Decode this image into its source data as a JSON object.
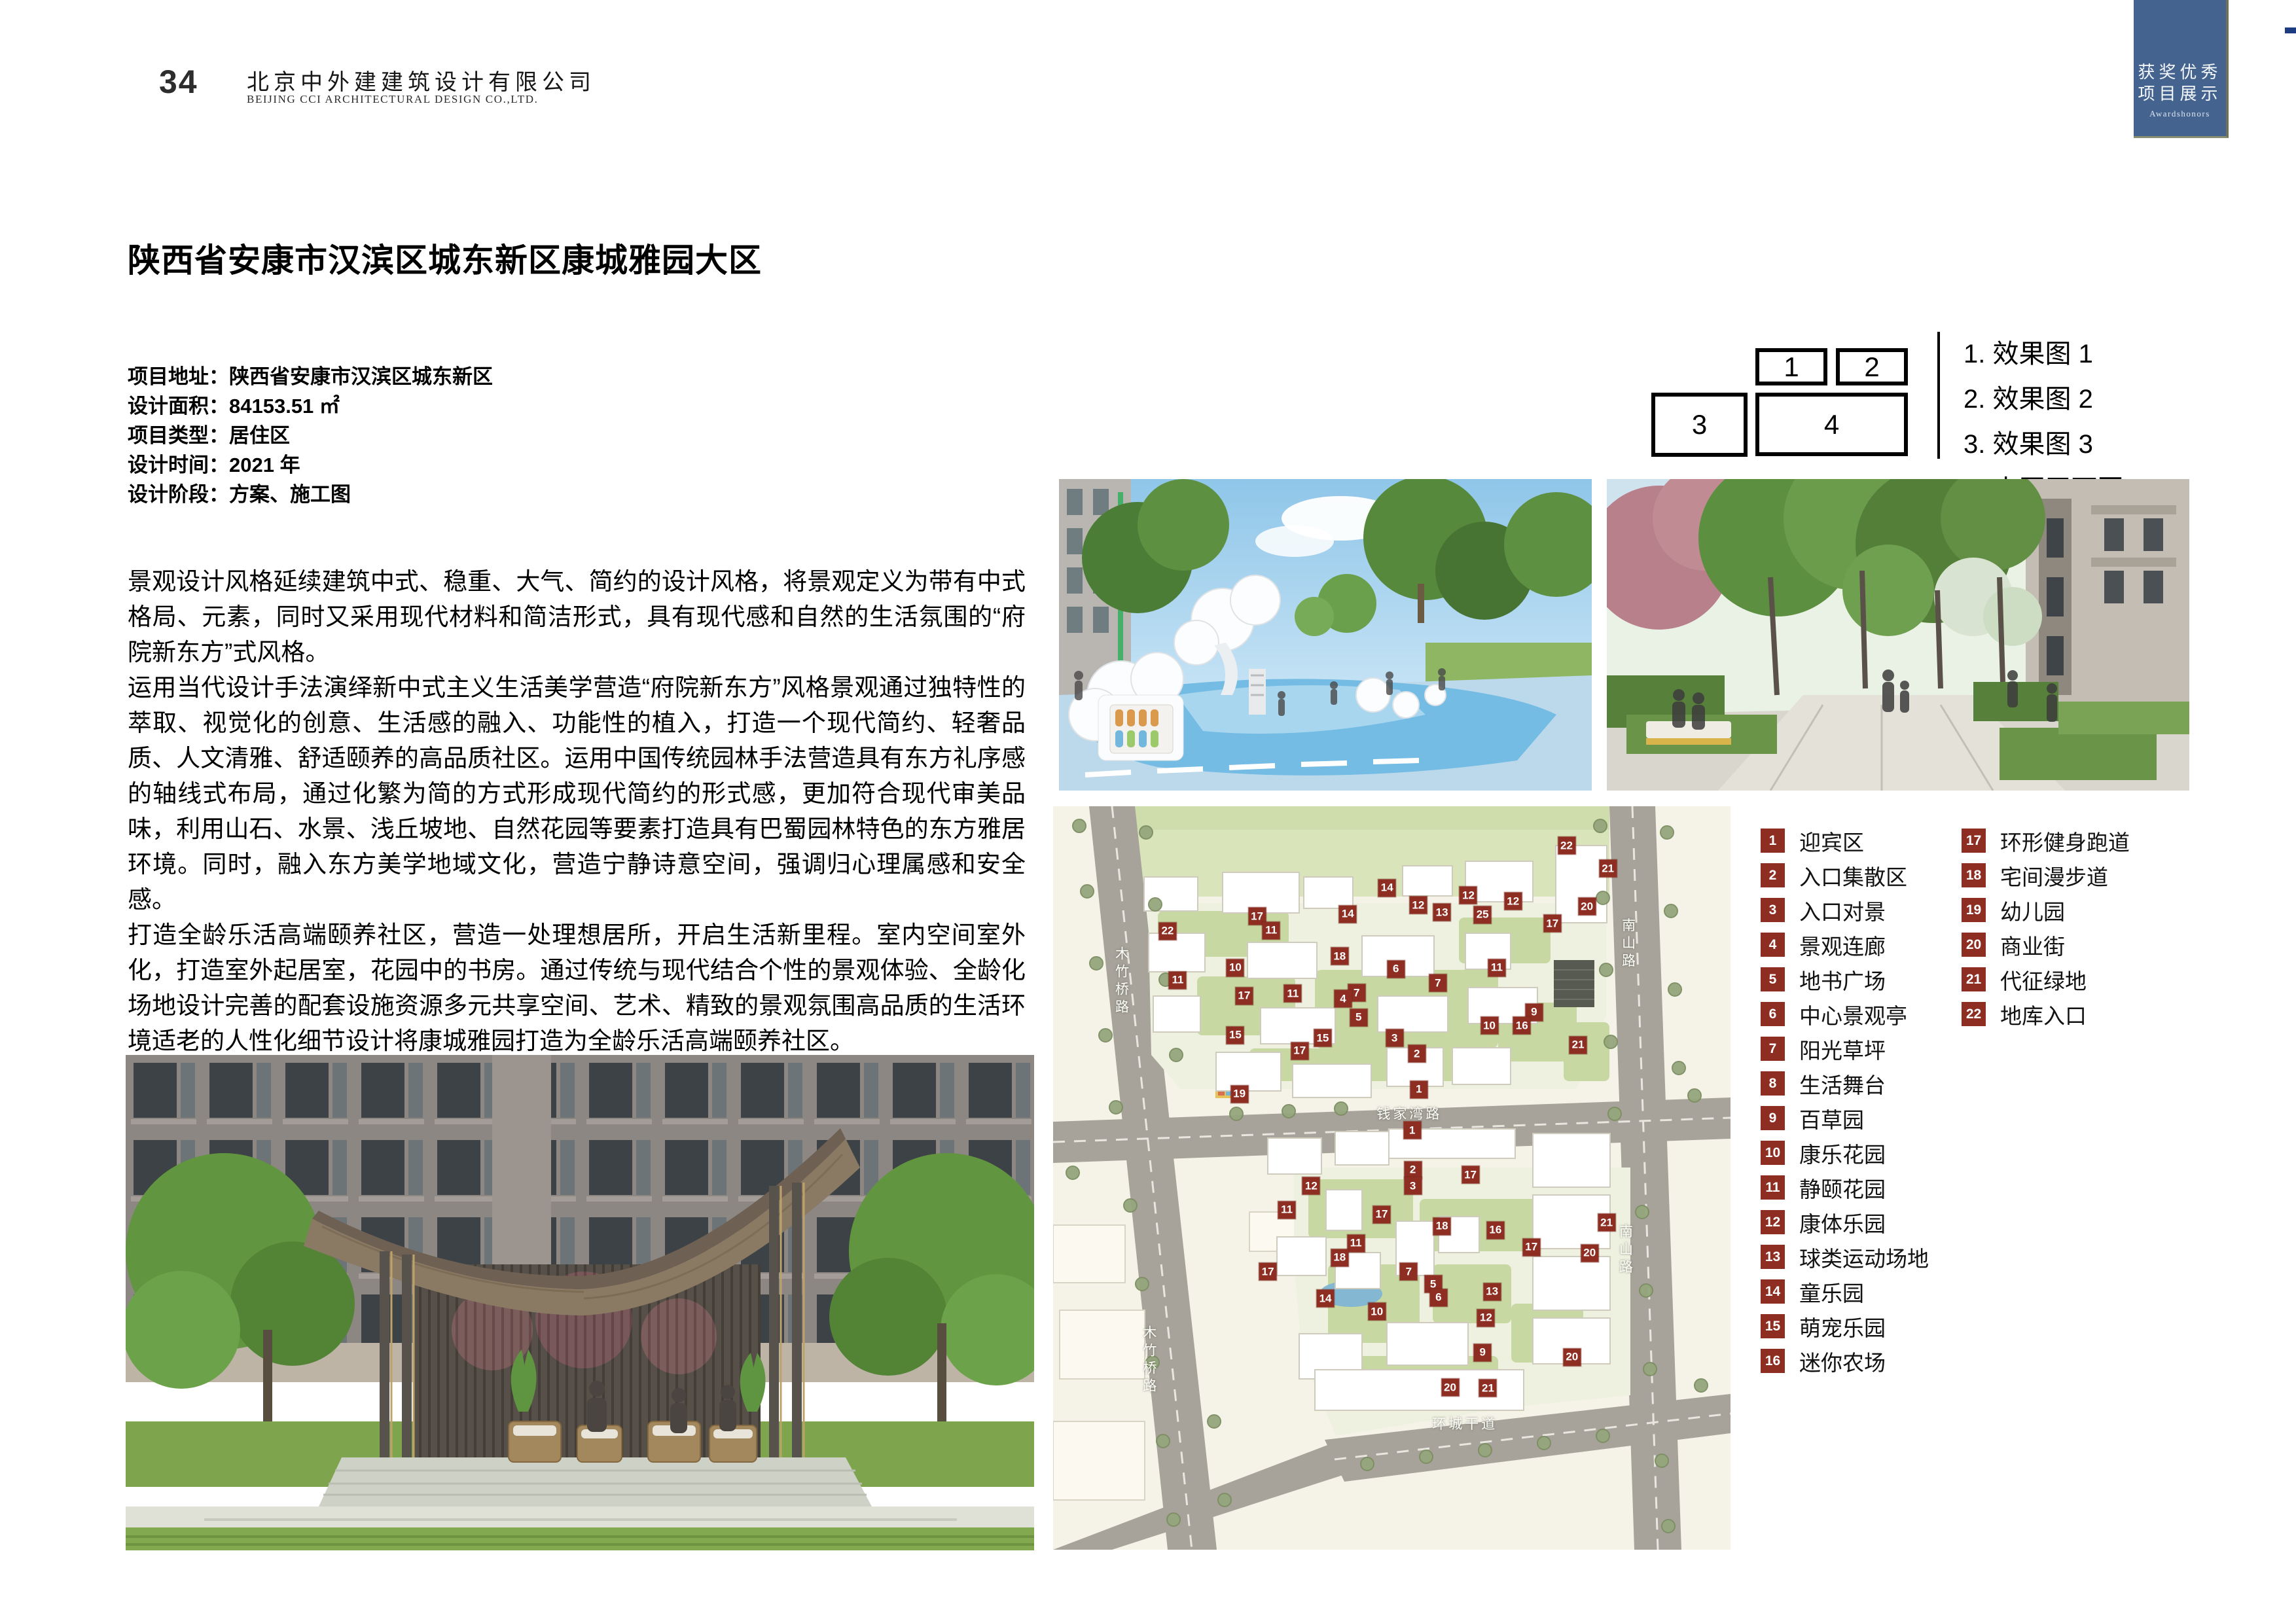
{
  "header": {
    "page_number": "34",
    "company_cn": "北京中外建建筑设计有限公司",
    "company_en": "BEIJING CCI ARCHITECTURAL DESIGN CO.,LTD."
  },
  "corner_tab": {
    "title_line1": "获奖优秀",
    "title_line2": "项目展示",
    "subtitle": "Awardshonors",
    "bg_color": "#44648f"
  },
  "project": {
    "title": "陕西省安康市汉滨区城东新区康城雅园大区",
    "info_rows": [
      {
        "label": "项目地址",
        "value": "陕西省安康市汉滨区城东新区"
      },
      {
        "label": "设计面积",
        "value": "84153.51 ㎡"
      },
      {
        "label": "项目类型",
        "value": "居住区"
      },
      {
        "label": "设计时间",
        "value": "2021 年"
      },
      {
        "label": "设计阶段",
        "value": "方案、施工图"
      }
    ],
    "description_p1": "景观设计风格延续建筑中式、稳重、大气、简约的设计风格，将景观定义为带有中式格局、元素，同时又采用现代材料和简洁形式，具有现代感和自然的生活氛围的“府院新东方”式风格。",
    "description_p2": "运用当代设计手法演绎新中式主义生活美学营造“府院新东方”风格景观通过独特性的萃取、视觉化的创意、生活感的融入、功能性的植入，打造一个现代简约、轻奢品质、人文清雅、舒适颐养的高品质社区。运用中国传统园林手法营造具有东方礼序感的轴线式布局，通过化繁为简的方式形成现代简约的形式感，更加符合现代审美品味，利用山石、水景、浅丘坡地、自然花园等要素打造具有巴蜀园林特色的东方雅居环境。同时，融入东方美学地域文化，营造宁静诗意空间，强调归心理属感和安全感。",
    "description_p3": "打造全龄乐活高端颐养社区，营造一处理想居所，开启生活新里程。室内空间室外化，打造室外起居室，花园中的书房。通过传统与现代结合个性的景观体验、全龄化场地设计完善的配套设施资源多元共享空间、艺术、精致的景观氛围高品质的生活环境适老的人性化细节设计将康城雅园打造为全龄乐活高端颐养社区。"
  },
  "key_diagram": {
    "boxes": [
      "1",
      "2",
      "3",
      "4"
    ],
    "list": [
      "1. 效果图 1",
      "2. 效果图 2",
      "3. 效果图 3",
      "4. 小区平面图"
    ]
  },
  "legend": {
    "badge_color": "#8e2e23",
    "columns": [
      [
        {
          "n": "1",
          "label": "迎宾区"
        },
        {
          "n": "2",
          "label": "入口集散区"
        },
        {
          "n": "3",
          "label": "入口对景"
        },
        {
          "n": "4",
          "label": "景观连廊"
        },
        {
          "n": "5",
          "label": "地书广场"
        },
        {
          "n": "6",
          "label": "中心景观亭"
        },
        {
          "n": "7",
          "label": "阳光草坪"
        },
        {
          "n": "8",
          "label": "生活舞台"
        },
        {
          "n": "9",
          "label": "百草园"
        },
        {
          "n": "10",
          "label": "康乐花园"
        },
        {
          "n": "11",
          "label": "静颐花园"
        },
        {
          "n": "12",
          "label": "康体乐园"
        },
        {
          "n": "13",
          "label": "球类运动场地"
        },
        {
          "n": "14",
          "label": "童乐园"
        },
        {
          "n": "15",
          "label": "萌宠乐园"
        },
        {
          "n": "16",
          "label": "迷你农场"
        }
      ],
      [
        {
          "n": "17",
          "label": "环形健身跑道"
        },
        {
          "n": "18",
          "label": "宅间漫步道"
        },
        {
          "n": "19",
          "label": "幼儿园"
        },
        {
          "n": "20",
          "label": "商业街"
        },
        {
          "n": "21",
          "label": "代征绿地"
        },
        {
          "n": "22",
          "label": "地库入口"
        }
      ]
    ]
  },
  "plan": {
    "road_labels": [
      {
        "text": "钱家湾路",
        "x": 52.6,
        "y": 41.3,
        "vertical": false
      },
      {
        "text": "环城干道",
        "x": 60.8,
        "y": 83.0,
        "vertical": false
      },
      {
        "text": "木竹桥路",
        "x": 10.0,
        "y": 23.6,
        "vertical": true
      },
      {
        "text": "木竹桥路",
        "x": 14.1,
        "y": 74.6,
        "vertical": true
      },
      {
        "text": "南山路",
        "x": 84.8,
        "y": 18.6,
        "vertical": true
      },
      {
        "text": "南山路",
        "x": 84.4,
        "y": 59.8,
        "vertical": true
      }
    ],
    "markers": [
      {
        "n": "22",
        "x": 75.8,
        "y": 5.3
      },
      {
        "n": "21",
        "x": 81.9,
        "y": 8.4
      },
      {
        "n": "14",
        "x": 49.3,
        "y": 11.0
      },
      {
        "n": "12",
        "x": 53.9,
        "y": 13.3
      },
      {
        "n": "12",
        "x": 61.3,
        "y": 12.0
      },
      {
        "n": "13",
        "x": 57.4,
        "y": 14.3
      },
      {
        "n": "25",
        "x": 63.4,
        "y": 14.6
      },
      {
        "n": "12",
        "x": 67.9,
        "y": 12.8
      },
      {
        "n": "20",
        "x": 78.8,
        "y": 13.5
      },
      {
        "n": "17",
        "x": 73.7,
        "y": 15.8
      },
      {
        "n": "14",
        "x": 43.5,
        "y": 14.5
      },
      {
        "n": "17",
        "x": 30.1,
        "y": 14.8
      },
      {
        "n": "11",
        "x": 32.2,
        "y": 16.7
      },
      {
        "n": "22",
        "x": 16.9,
        "y": 16.8
      },
      {
        "n": "18",
        "x": 42.3,
        "y": 20.2
      },
      {
        "n": "6",
        "x": 50.6,
        "y": 21.9
      },
      {
        "n": "10",
        "x": 26.9,
        "y": 21.7
      },
      {
        "n": "11",
        "x": 18.4,
        "y": 23.4
      },
      {
        "n": "7",
        "x": 44.8,
        "y": 25.1
      },
      {
        "n": "7",
        "x": 56.8,
        "y": 23.8
      },
      {
        "n": "4",
        "x": 42.8,
        "y": 25.9
      },
      {
        "n": "17",
        "x": 28.2,
        "y": 25.5
      },
      {
        "n": "11",
        "x": 35.4,
        "y": 25.2
      },
      {
        "n": "11",
        "x": 65.5,
        "y": 21.7
      },
      {
        "n": "5",
        "x": 45.1,
        "y": 28.4
      },
      {
        "n": "9",
        "x": 71.0,
        "y": 27.7
      },
      {
        "n": "10",
        "x": 64.4,
        "y": 29.5
      },
      {
        "n": "16",
        "x": 69.2,
        "y": 29.5
      },
      {
        "n": "15",
        "x": 26.9,
        "y": 30.8
      },
      {
        "n": "15",
        "x": 39.8,
        "y": 31.2
      },
      {
        "n": "3",
        "x": 50.4,
        "y": 31.2
      },
      {
        "n": "17",
        "x": 36.4,
        "y": 32.9
      },
      {
        "n": "2",
        "x": 53.7,
        "y": 33.3
      },
      {
        "n": "21",
        "x": 77.5,
        "y": 32.1
      },
      {
        "n": "1",
        "x": 54.0,
        "y": 38.1
      },
      {
        "n": "19",
        "x": 27.5,
        "y": 38.7
      },
      {
        "n": "1",
        "x": 53.0,
        "y": 43.6
      },
      {
        "n": "2",
        "x": 53.1,
        "y": 48.9
      },
      {
        "n": "3",
        "x": 53.1,
        "y": 51.1
      },
      {
        "n": "17",
        "x": 61.6,
        "y": 49.6
      },
      {
        "n": "12",
        "x": 38.1,
        "y": 51.1
      },
      {
        "n": "11",
        "x": 34.5,
        "y": 54.3
      },
      {
        "n": "17",
        "x": 48.5,
        "y": 54.9
      },
      {
        "n": "18",
        "x": 57.4,
        "y": 56.5
      },
      {
        "n": "16",
        "x": 65.3,
        "y": 57.0
      },
      {
        "n": "11",
        "x": 44.7,
        "y": 58.8
      },
      {
        "n": "18",
        "x": 42.3,
        "y": 60.7
      },
      {
        "n": "17",
        "x": 31.7,
        "y": 62.6
      },
      {
        "n": "7",
        "x": 52.5,
        "y": 62.6
      },
      {
        "n": "17",
        "x": 70.6,
        "y": 59.3
      },
      {
        "n": "21",
        "x": 81.7,
        "y": 56.0
      },
      {
        "n": "20",
        "x": 79.2,
        "y": 60.1
      },
      {
        "n": "14",
        "x": 40.2,
        "y": 66.2
      },
      {
        "n": "5",
        "x": 56.1,
        "y": 64.3
      },
      {
        "n": "6",
        "x": 56.9,
        "y": 66.1
      },
      {
        "n": "13",
        "x": 64.8,
        "y": 65.3
      },
      {
        "n": "10",
        "x": 47.8,
        "y": 68.0
      },
      {
        "n": "12",
        "x": 63.9,
        "y": 68.8
      },
      {
        "n": "9",
        "x": 63.4,
        "y": 73.5
      },
      {
        "n": "20",
        "x": 76.6,
        "y": 74.1
      },
      {
        "n": "20",
        "x": 58.6,
        "y": 78.2
      },
      {
        "n": "21",
        "x": 64.2,
        "y": 78.3
      }
    ]
  }
}
